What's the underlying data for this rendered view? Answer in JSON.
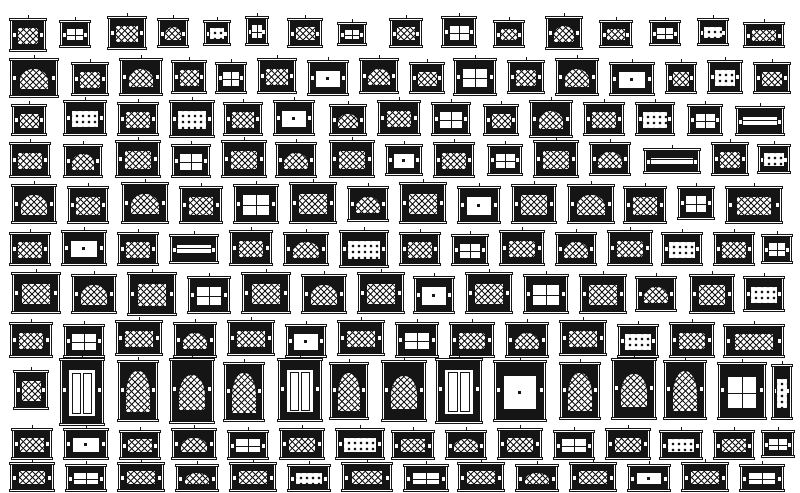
{
  "page": {
    "description": "Catalogue sheet of ornate window and mantel CAD elevation blocks, black ink on white",
    "background": "#ffffff",
    "ink": "#151515"
  },
  "canvas": {
    "width": 800,
    "height": 493
  },
  "block_types": [
    "lattice-window",
    "arched-lattice-window",
    "paned-window",
    "plain-panel",
    "coffered-grid",
    "double-door",
    "arched-lattice-door",
    "shelf-lines"
  ],
  "rows": [
    {
      "y": 16,
      "items": [
        [
          10,
          36,
          34,
          0,
          2
        ],
        [
          60,
          30,
          28,
          2,
          4
        ],
        [
          108,
          38,
          34,
          0,
          0
        ],
        [
          158,
          30,
          30,
          1,
          2
        ],
        [
          204,
          26,
          26,
          4,
          4
        ],
        [
          246,
          22,
          30,
          2,
          0
        ],
        [
          288,
          34,
          30,
          0,
          2
        ],
        [
          338,
          28,
          24,
          2,
          6
        ],
        [
          390,
          32,
          30,
          0,
          2
        ],
        [
          442,
          34,
          32,
          2,
          0
        ],
        [
          494,
          30,
          28,
          0,
          4
        ],
        [
          546,
          36,
          34,
          1,
          0
        ],
        [
          600,
          32,
          28,
          0,
          4
        ],
        [
          650,
          30,
          26,
          2,
          4
        ],
        [
          698,
          30,
          28,
          4,
          2
        ],
        [
          744,
          40,
          26,
          0,
          6
        ]
      ]
    },
    {
      "y": 58,
      "items": [
        [
          10,
          48,
          40,
          1,
          0
        ],
        [
          72,
          36,
          34,
          0,
          4
        ],
        [
          120,
          42,
          38,
          1,
          0
        ],
        [
          172,
          34,
          34,
          0,
          2
        ],
        [
          216,
          30,
          32,
          2,
          4
        ],
        [
          258,
          38,
          36,
          0,
          0
        ],
        [
          308,
          40,
          36,
          3,
          2
        ],
        [
          360,
          38,
          36,
          1,
          0
        ],
        [
          410,
          34,
          32,
          0,
          4
        ],
        [
          454,
          42,
          38,
          2,
          0
        ],
        [
          508,
          36,
          34,
          0,
          2
        ],
        [
          556,
          42,
          38,
          1,
          0
        ],
        [
          610,
          44,
          34,
          3,
          4
        ],
        [
          666,
          30,
          32,
          0,
          4
        ],
        [
          708,
          34,
          34,
          4,
          2
        ],
        [
          754,
          36,
          32,
          0,
          4
        ]
      ]
    },
    {
      "y": 100,
      "items": [
        [
          12,
          34,
          32,
          0,
          4
        ],
        [
          64,
          42,
          36,
          4,
          0
        ],
        [
          118,
          40,
          34,
          0,
          2
        ],
        [
          170,
          44,
          38,
          4,
          0
        ],
        [
          224,
          38,
          34,
          0,
          2
        ],
        [
          274,
          40,
          36,
          3,
          0
        ],
        [
          330,
          36,
          32,
          1,
          4
        ],
        [
          378,
          42,
          36,
          0,
          0
        ],
        [
          432,
          38,
          34,
          2,
          2
        ],
        [
          484,
          34,
          32,
          0,
          4
        ],
        [
          530,
          42,
          38,
          1,
          0
        ],
        [
          584,
          40,
          34,
          0,
          2
        ],
        [
          636,
          38,
          34,
          4,
          2
        ],
        [
          688,
          34,
          32,
          2,
          4
        ],
        [
          736,
          48,
          30,
          7,
          6
        ]
      ]
    },
    {
      "y": 140,
      "items": [
        [
          10,
          40,
          36,
          0,
          2
        ],
        [
          64,
          38,
          34,
          1,
          4
        ],
        [
          116,
          44,
          38,
          0,
          0
        ],
        [
          172,
          38,
          34,
          2,
          4
        ],
        [
          222,
          44,
          38,
          0,
          0
        ],
        [
          276,
          40,
          36,
          1,
          2
        ],
        [
          330,
          44,
          38,
          0,
          0
        ],
        [
          386,
          36,
          32,
          3,
          4
        ],
        [
          434,
          40,
          36,
          0,
          2
        ],
        [
          488,
          34,
          32,
          2,
          4
        ],
        [
          534,
          44,
          38,
          0,
          0
        ],
        [
          590,
          40,
          34,
          1,
          2
        ],
        [
          644,
          56,
          26,
          7,
          8
        ],
        [
          712,
          36,
          34,
          0,
          2
        ],
        [
          758,
          32,
          30,
          4,
          4
        ]
      ]
    },
    {
      "y": 182,
      "items": [
        [
          12,
          44,
          40,
          1,
          2
        ],
        [
          68,
          40,
          38,
          0,
          4
        ],
        [
          122,
          46,
          42,
          1,
          0
        ],
        [
          180,
          42,
          38,
          0,
          4
        ],
        [
          234,
          44,
          40,
          2,
          2
        ],
        [
          290,
          46,
          42,
          0,
          0
        ],
        [
          348,
          40,
          36,
          1,
          4
        ],
        [
          400,
          46,
          42,
          0,
          0
        ],
        [
          458,
          42,
          38,
          3,
          4
        ],
        [
          512,
          44,
          40,
          0,
          2
        ],
        [
          568,
          46,
          40,
          1,
          2
        ],
        [
          624,
          42,
          38,
          0,
          4
        ],
        [
          678,
          36,
          34,
          2,
          4
        ],
        [
          726,
          56,
          38,
          0,
          4
        ]
      ]
    },
    {
      "y": 230,
      "items": [
        [
          10,
          40,
          34,
          0,
          2
        ],
        [
          62,
          44,
          36,
          3,
          0
        ],
        [
          118,
          40,
          34,
          0,
          2
        ],
        [
          170,
          48,
          30,
          7,
          4
        ],
        [
          230,
          42,
          36,
          0,
          0
        ],
        [
          284,
          44,
          34,
          1,
          2
        ],
        [
          340,
          48,
          38,
          4,
          0
        ],
        [
          400,
          40,
          34,
          0,
          2
        ],
        [
          452,
          36,
          32,
          2,
          4
        ],
        [
          500,
          44,
          36,
          0,
          0
        ],
        [
          556,
          40,
          34,
          1,
          2
        ],
        [
          608,
          44,
          36,
          0,
          0
        ],
        [
          662,
          40,
          34,
          4,
          2
        ],
        [
          714,
          40,
          34,
          0,
          2
        ],
        [
          762,
          30,
          30,
          2,
          4
        ]
      ]
    },
    {
      "y": 272,
      "items": [
        [
          12,
          48,
          42,
          0,
          0
        ],
        [
          72,
          44,
          40,
          1,
          2
        ],
        [
          128,
          48,
          44,
          0,
          0
        ],
        [
          188,
          42,
          38,
          2,
          4
        ],
        [
          242,
          48,
          42,
          0,
          0
        ],
        [
          302,
          44,
          40,
          1,
          2
        ],
        [
          358,
          46,
          42,
          0,
          0
        ],
        [
          414,
          40,
          38,
          3,
          4
        ],
        [
          466,
          46,
          42,
          0,
          0
        ],
        [
          524,
          44,
          40,
          2,
          2
        ],
        [
          580,
          46,
          40,
          0,
          2
        ],
        [
          636,
          40,
          36,
          1,
          4
        ],
        [
          690,
          44,
          40,
          0,
          2
        ],
        [
          744,
          40,
          36,
          4,
          4
        ]
      ]
    },
    {
      "y": 320,
      "items": [
        [
          10,
          42,
          36,
          0,
          2
        ],
        [
          64,
          40,
          34,
          2,
          4
        ],
        [
          116,
          46,
          36,
          0,
          0
        ],
        [
          174,
          42,
          36,
          1,
          2
        ],
        [
          228,
          46,
          36,
          0,
          0
        ],
        [
          286,
          40,
          34,
          3,
          4
        ],
        [
          338,
          46,
          36,
          0,
          0
        ],
        [
          396,
          42,
          36,
          2,
          2
        ],
        [
          450,
          44,
          36,
          0,
          2
        ],
        [
          506,
          42,
          36,
          1,
          2
        ],
        [
          560,
          46,
          36,
          0,
          0
        ],
        [
          618,
          40,
          34,
          4,
          4
        ],
        [
          670,
          44,
          36,
          0,
          2
        ],
        [
          724,
          60,
          34,
          0,
          4
        ]
      ]
    },
    {
      "y": 358,
      "items": [
        [
          14,
          34,
          40,
          0,
          12
        ],
        [
          60,
          44,
          68,
          5,
          0
        ],
        [
          118,
          40,
          62,
          6,
          2
        ],
        [
          170,
          44,
          66,
          1,
          0
        ],
        [
          224,
          40,
          60,
          6,
          4
        ],
        [
          278,
          44,
          64,
          5,
          0
        ],
        [
          330,
          38,
          58,
          6,
          4
        ],
        [
          382,
          44,
          62,
          1,
          2
        ],
        [
          436,
          46,
          66,
          5,
          0
        ],
        [
          494,
          52,
          62,
          3,
          2
        ],
        [
          560,
          40,
          58,
          6,
          4
        ],
        [
          612,
          44,
          62,
          1,
          0
        ],
        [
          664,
          42,
          60,
          6,
          2
        ],
        [
          718,
          48,
          58,
          2,
          4
        ],
        [
          772,
          20,
          56,
          4,
          6
        ]
      ]
    },
    {
      "y": 428,
      "items": [
        [
          12,
          40,
          32,
          0,
          0
        ],
        [
          64,
          44,
          32,
          3,
          0
        ],
        [
          120,
          40,
          30,
          0,
          2
        ],
        [
          172,
          44,
          32,
          1,
          0
        ],
        [
          228,
          40,
          30,
          2,
          2
        ],
        [
          280,
          44,
          32,
          0,
          0
        ],
        [
          336,
          48,
          32,
          4,
          0
        ],
        [
          392,
          42,
          30,
          0,
          2
        ],
        [
          446,
          40,
          30,
          1,
          2
        ],
        [
          498,
          44,
          32,
          0,
          0
        ],
        [
          554,
          40,
          30,
          2,
          2
        ],
        [
          606,
          44,
          32,
          0,
          0
        ],
        [
          660,
          42,
          30,
          4,
          2
        ],
        [
          714,
          40,
          30,
          0,
          2
        ],
        [
          762,
          32,
          28,
          2,
          2
        ]
      ]
    },
    {
      "y": 462,
      "items": [
        [
          10,
          44,
          30,
          0,
          0
        ],
        [
          66,
          40,
          28,
          2,
          2
        ],
        [
          118,
          46,
          30,
          0,
          0
        ],
        [
          176,
          42,
          28,
          1,
          2
        ],
        [
          230,
          46,
          30,
          0,
          0
        ],
        [
          288,
          42,
          28,
          4,
          2
        ],
        [
          342,
          50,
          30,
          0,
          0
        ],
        [
          404,
          44,
          28,
          2,
          2
        ],
        [
          458,
          46,
          30,
          0,
          0
        ],
        [
          516,
          42,
          28,
          1,
          2
        ],
        [
          570,
          46,
          30,
          0,
          0
        ],
        [
          628,
          42,
          28,
          3,
          2
        ],
        [
          682,
          46,
          30,
          0,
          0
        ],
        [
          740,
          44,
          28,
          2,
          2
        ]
      ]
    }
  ]
}
